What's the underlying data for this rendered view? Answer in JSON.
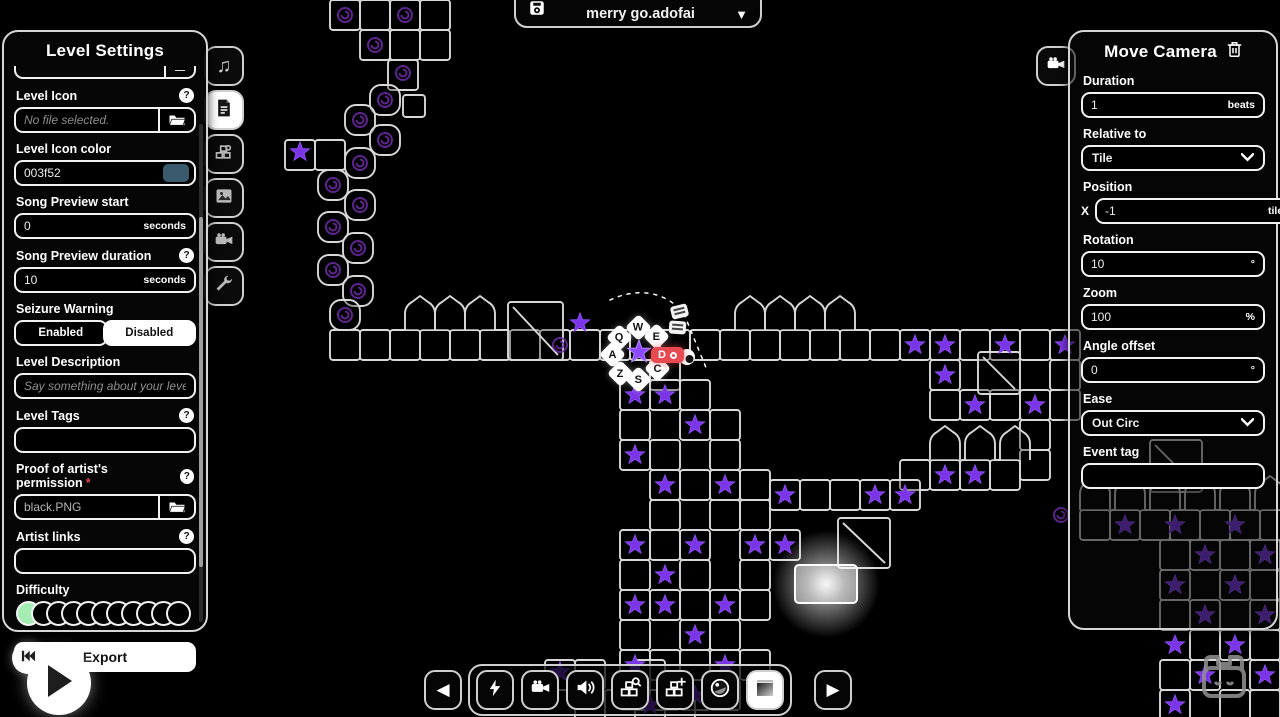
{
  "app": {
    "background": "#000000"
  },
  "icons": {
    "help_glyph": "?",
    "caret_down": "▼",
    "prev_arrow": "◀",
    "next_arrow": "▶"
  },
  "file_selector": {
    "filename": "merry go.adofai",
    "save_icon": "floppy-disk-icon",
    "dropdown_icon": "caret-down-icon"
  },
  "level_settings": {
    "title": "Level Settings",
    "partial_field": {
      "button_label": "—"
    },
    "level_icon": {
      "label": "Level Icon",
      "placeholder": "No file selected.",
      "button_icon": "folder-icon"
    },
    "level_icon_color": {
      "label": "Level Icon color",
      "value": "003f52",
      "swatch_color": "#3a5a6e"
    },
    "song_preview_start": {
      "label": "Song Preview start",
      "value": "0",
      "suffix": "seconds"
    },
    "song_preview_duration": {
      "label": "Song Preview duration",
      "value": "10",
      "suffix": "seconds"
    },
    "seizure_warning": {
      "label": "Seizure Warning",
      "options": [
        "Enabled",
        "Disabled"
      ],
      "selected": "Disabled"
    },
    "level_description": {
      "label": "Level Description",
      "placeholder": "Say something about your level!"
    },
    "level_tags": {
      "label": "Level Tags",
      "value": ""
    },
    "artist_permission": {
      "label": "Proof of artist's permission",
      "required_mark": "*",
      "value": "black.PNG",
      "button_icon": "folder-icon"
    },
    "artist_links": {
      "label": "Artist links",
      "value": ""
    },
    "difficulty": {
      "label": "Difficulty",
      "total": 11,
      "selected_index": 0,
      "selected_color": "#a5ecb2"
    },
    "export_label": "Export"
  },
  "side_tabs": [
    {
      "icon": "music-note-icon",
      "active": false
    },
    {
      "icon": "file-settings-icon",
      "active": true
    },
    {
      "icon": "decorations-icon",
      "active": false
    },
    {
      "icon": "image-icon",
      "active": false
    },
    {
      "icon": "camera-icon",
      "active": false
    },
    {
      "icon": "wrench-icon",
      "active": false
    }
  ],
  "move_camera": {
    "title": "Move Camera",
    "tab_icon": "video-camera-icon",
    "delete_icon": "trash-icon",
    "duration": {
      "label": "Duration",
      "value": "1",
      "suffix": "beats"
    },
    "relative_to": {
      "label": "Relative to",
      "value": "Tile"
    },
    "position": {
      "label": "Position",
      "x_label": "X",
      "x_value": "-1",
      "x_suffix": "tiles",
      "y_label": "Y",
      "y_value": "1",
      "y_suffix": "tiles"
    },
    "rotation": {
      "label": "Rotation",
      "value": "10",
      "suffix": "°"
    },
    "zoom": {
      "label": "Zoom",
      "value": "100",
      "suffix": "%"
    },
    "angle_offset": {
      "label": "Angle offset",
      "value": "0",
      "suffix": "°"
    },
    "ease": {
      "label": "Ease",
      "value": "Out Circ"
    },
    "event_tag": {
      "label": "Event tag",
      "value": ""
    }
  },
  "playback": {
    "play_icon": "play-icon",
    "rewind_icon": "skip-to-start-icon"
  },
  "toolbar": {
    "buttons": [
      {
        "icon": "prev-arrow-icon"
      },
      {
        "icon": "lightning-icon"
      },
      {
        "icon": "video-camera-icon"
      },
      {
        "icon": "speaker-icon"
      },
      {
        "icon": "decoration-select-icon"
      },
      {
        "icon": "decoration-add-icon"
      },
      {
        "icon": "lens-icon"
      },
      {
        "icon": "media-frame-icon"
      },
      {
        "icon": "next-arrow-icon"
      }
    ]
  },
  "mascot": {
    "icon": "cat-mask-icon"
  },
  "key_hints": {
    "keys": [
      {
        "label": "Q",
        "x": 620,
        "y": 338
      },
      {
        "label": "W",
        "x": 639,
        "y": 328
      },
      {
        "label": "E",
        "x": 657,
        "y": 337
      },
      {
        "label": "A",
        "x": 613,
        "y": 355
      },
      {
        "label": "Z",
        "x": 621,
        "y": 374
      },
      {
        "label": "S",
        "x": 639,
        "y": 380
      },
      {
        "label": "C",
        "x": 658,
        "y": 369
      }
    ],
    "active": {
      "label": "D"
    }
  },
  "track": {
    "colors": {
      "stroke": "#d8d8d8",
      "star": "#7b35e8",
      "swirl": "#6e2ba8"
    },
    "tiles": [
      [
        330,
        0
      ],
      [
        360,
        0
      ],
      [
        390,
        0
      ],
      [
        420,
        0
      ],
      [
        360,
        30
      ],
      [
        390,
        30
      ],
      [
        420,
        30
      ],
      [
        388,
        60
      ],
      [
        403,
        95,
        22,
        22
      ],
      [
        285,
        140
      ],
      [
        315,
        140
      ],
      [
        330,
        330
      ],
      [
        360,
        330
      ],
      [
        390,
        330
      ],
      [
        420,
        330
      ],
      [
        450,
        330
      ],
      [
        480,
        330
      ],
      [
        510,
        330
      ],
      [
        540,
        330
      ],
      [
        570,
        330
      ],
      [
        600,
        330
      ],
      [
        630,
        330
      ],
      [
        660,
        330
      ],
      [
        690,
        330
      ],
      [
        720,
        330
      ],
      [
        750,
        330
      ],
      [
        780,
        330
      ],
      [
        810,
        330
      ],
      [
        840,
        330
      ],
      [
        870,
        330
      ],
      [
        900,
        330
      ],
      [
        930,
        330
      ],
      [
        960,
        330
      ],
      [
        990,
        330
      ],
      [
        1020,
        330
      ],
      [
        1050,
        330
      ],
      [
        930,
        360
      ],
      [
        1050,
        360
      ],
      [
        930,
        390
      ],
      [
        960,
        390
      ],
      [
        990,
        390
      ],
      [
        1020,
        390
      ],
      [
        1050,
        390
      ],
      [
        1020,
        420
      ],
      [
        1020,
        450
      ],
      [
        900,
        460
      ],
      [
        930,
        460
      ],
      [
        960,
        460
      ],
      [
        990,
        460
      ],
      [
        1080,
        510
      ],
      [
        1110,
        510
      ],
      [
        1140,
        510
      ],
      [
        1170,
        510
      ],
      [
        1200,
        510
      ],
      [
        1230,
        510
      ],
      [
        1260,
        510
      ],
      [
        1160,
        540
      ],
      [
        1190,
        540
      ],
      [
        1220,
        540
      ],
      [
        1250,
        540
      ],
      [
        1160,
        570
      ],
      [
        1220,
        570
      ],
      [
        1250,
        570
      ],
      [
        1160,
        600
      ],
      [
        1190,
        600
      ],
      [
        1250,
        600
      ],
      [
        1190,
        630
      ],
      [
        1220,
        630
      ],
      [
        1250,
        630
      ],
      [
        1160,
        660
      ],
      [
        1190,
        660
      ],
      [
        1250,
        660
      ],
      [
        1160,
        690
      ],
      [
        1220,
        690
      ],
      [
        1250,
        690
      ],
      [
        650,
        360
      ],
      [
        620,
        380
      ],
      [
        650,
        380
      ],
      [
        680,
        380
      ],
      [
        620,
        410
      ],
      [
        680,
        410
      ],
      [
        710,
        410
      ],
      [
        620,
        440
      ],
      [
        650,
        440
      ],
      [
        710,
        440
      ],
      [
        650,
        470
      ],
      [
        680,
        470
      ],
      [
        710,
        470
      ],
      [
        740,
        470
      ],
      [
        650,
        500
      ],
      [
        710,
        500
      ],
      [
        740,
        500
      ],
      [
        620,
        530
      ],
      [
        650,
        530
      ],
      [
        680,
        530
      ],
      [
        740,
        530
      ],
      [
        770,
        530
      ],
      [
        620,
        560
      ],
      [
        680,
        560
      ],
      [
        740,
        560
      ],
      [
        620,
        590
      ],
      [
        650,
        590
      ],
      [
        680,
        590
      ],
      [
        710,
        590
      ],
      [
        740,
        590
      ],
      [
        620,
        620
      ],
      [
        680,
        620
      ],
      [
        710,
        620
      ],
      [
        620,
        650
      ],
      [
        650,
        650
      ],
      [
        680,
        650
      ],
      [
        710,
        650
      ],
      [
        740,
        650
      ],
      [
        620,
        680
      ],
      [
        650,
        680
      ],
      [
        680,
        680
      ],
      [
        710,
        680
      ],
      [
        545,
        660
      ],
      [
        575,
        660
      ],
      [
        575,
        690
      ],
      [
        605,
        690
      ],
      [
        635,
        660
      ],
      [
        665,
        690
      ],
      [
        770,
        480
      ],
      [
        800,
        480
      ],
      [
        830,
        480
      ],
      [
        860,
        480
      ],
      [
        890,
        480
      ]
    ],
    "drops": [
      [
        370,
        85
      ],
      [
        345,
        105
      ],
      [
        370,
        125
      ],
      [
        345,
        148
      ],
      [
        318,
        170
      ],
      [
        345,
        190
      ],
      [
        318,
        212
      ],
      [
        343,
        233
      ],
      [
        318,
        255
      ],
      [
        343,
        276
      ],
      [
        330,
        300
      ]
    ],
    "turns": [
      [
        508,
        302,
        55,
        58
      ],
      [
        838,
        518,
        52,
        50
      ],
      [
        978,
        352,
        42,
        42
      ],
      [
        1150,
        440,
        52,
        52
      ]
    ],
    "arches": [
      [
        405,
        300
      ],
      [
        435,
        300
      ],
      [
        465,
        300
      ],
      [
        735,
        300
      ],
      [
        765,
        300
      ],
      [
        795,
        300
      ],
      [
        825,
        300
      ],
      [
        930,
        430
      ],
      [
        965,
        430
      ],
      [
        1000,
        430
      ],
      [
        1080,
        480
      ],
      [
        1115,
        480
      ],
      [
        1150,
        480
      ],
      [
        1185,
        480
      ],
      [
        1220,
        480
      ],
      [
        1255,
        480
      ]
    ],
    "stars": [
      [
        300,
        152
      ],
      [
        580,
        323
      ],
      [
        915,
        345
      ],
      [
        945,
        345
      ],
      [
        1005,
        345
      ],
      [
        1065,
        345
      ],
      [
        945,
        375
      ],
      [
        975,
        405
      ],
      [
        1035,
        405
      ],
      [
        945,
        475
      ],
      [
        975,
        475
      ],
      [
        785,
        495
      ],
      [
        875,
        495
      ],
      [
        905,
        495
      ],
      [
        635,
        395
      ],
      [
        665,
        395
      ],
      [
        695,
        425
      ],
      [
        635,
        455
      ],
      [
        665,
        485
      ],
      [
        725,
        485
      ],
      [
        755,
        545
      ],
      [
        635,
        545
      ],
      [
        695,
        545
      ],
      [
        665,
        575
      ],
      [
        635,
        605
      ],
      [
        665,
        605
      ],
      [
        725,
        605
      ],
      [
        695,
        635
      ],
      [
        635,
        665
      ],
      [
        725,
        665
      ],
      [
        665,
        695
      ],
      [
        695,
        695
      ],
      [
        785,
        545
      ],
      [
        1125,
        525
      ],
      [
        1175,
        525
      ],
      [
        1235,
        525
      ],
      [
        1205,
        555
      ],
      [
        1265,
        555
      ],
      [
        1175,
        585
      ],
      [
        1235,
        585
      ],
      [
        1205,
        615
      ],
      [
        1265,
        615
      ],
      [
        1175,
        645
      ],
      [
        1235,
        645
      ],
      [
        1205,
        675
      ],
      [
        1265,
        675
      ],
      [
        1175,
        705
      ],
      [
        560,
        672
      ],
      [
        650,
        705
      ]
    ],
    "bright_star": [
      639,
      352
    ],
    "swirls": [
      [
        345,
        15
      ],
      [
        405,
        15
      ],
      [
        375,
        45
      ],
      [
        403,
        73
      ],
      [
        385,
        100
      ],
      [
        360,
        120
      ],
      [
        385,
        140
      ],
      [
        360,
        163
      ],
      [
        333,
        185
      ],
      [
        360,
        205
      ],
      [
        333,
        227
      ],
      [
        358,
        248
      ],
      [
        333,
        270
      ],
      [
        358,
        291
      ],
      [
        345,
        315
      ],
      [
        560,
        345
      ],
      [
        1061,
        515
      ]
    ],
    "glow_tile": [
      795,
      565,
      62,
      38
    ],
    "glow_center": [
      826,
      584
    ],
    "trajectory": [
      "M610,300 C640,286 668,293 684,314",
      "M684,314 L707,370"
    ],
    "planet": {
      "x": 687,
      "y": 357,
      "r": 8
    },
    "event_markers": [
      [
        671,
        305
      ],
      [
        669,
        321
      ]
    ]
  }
}
